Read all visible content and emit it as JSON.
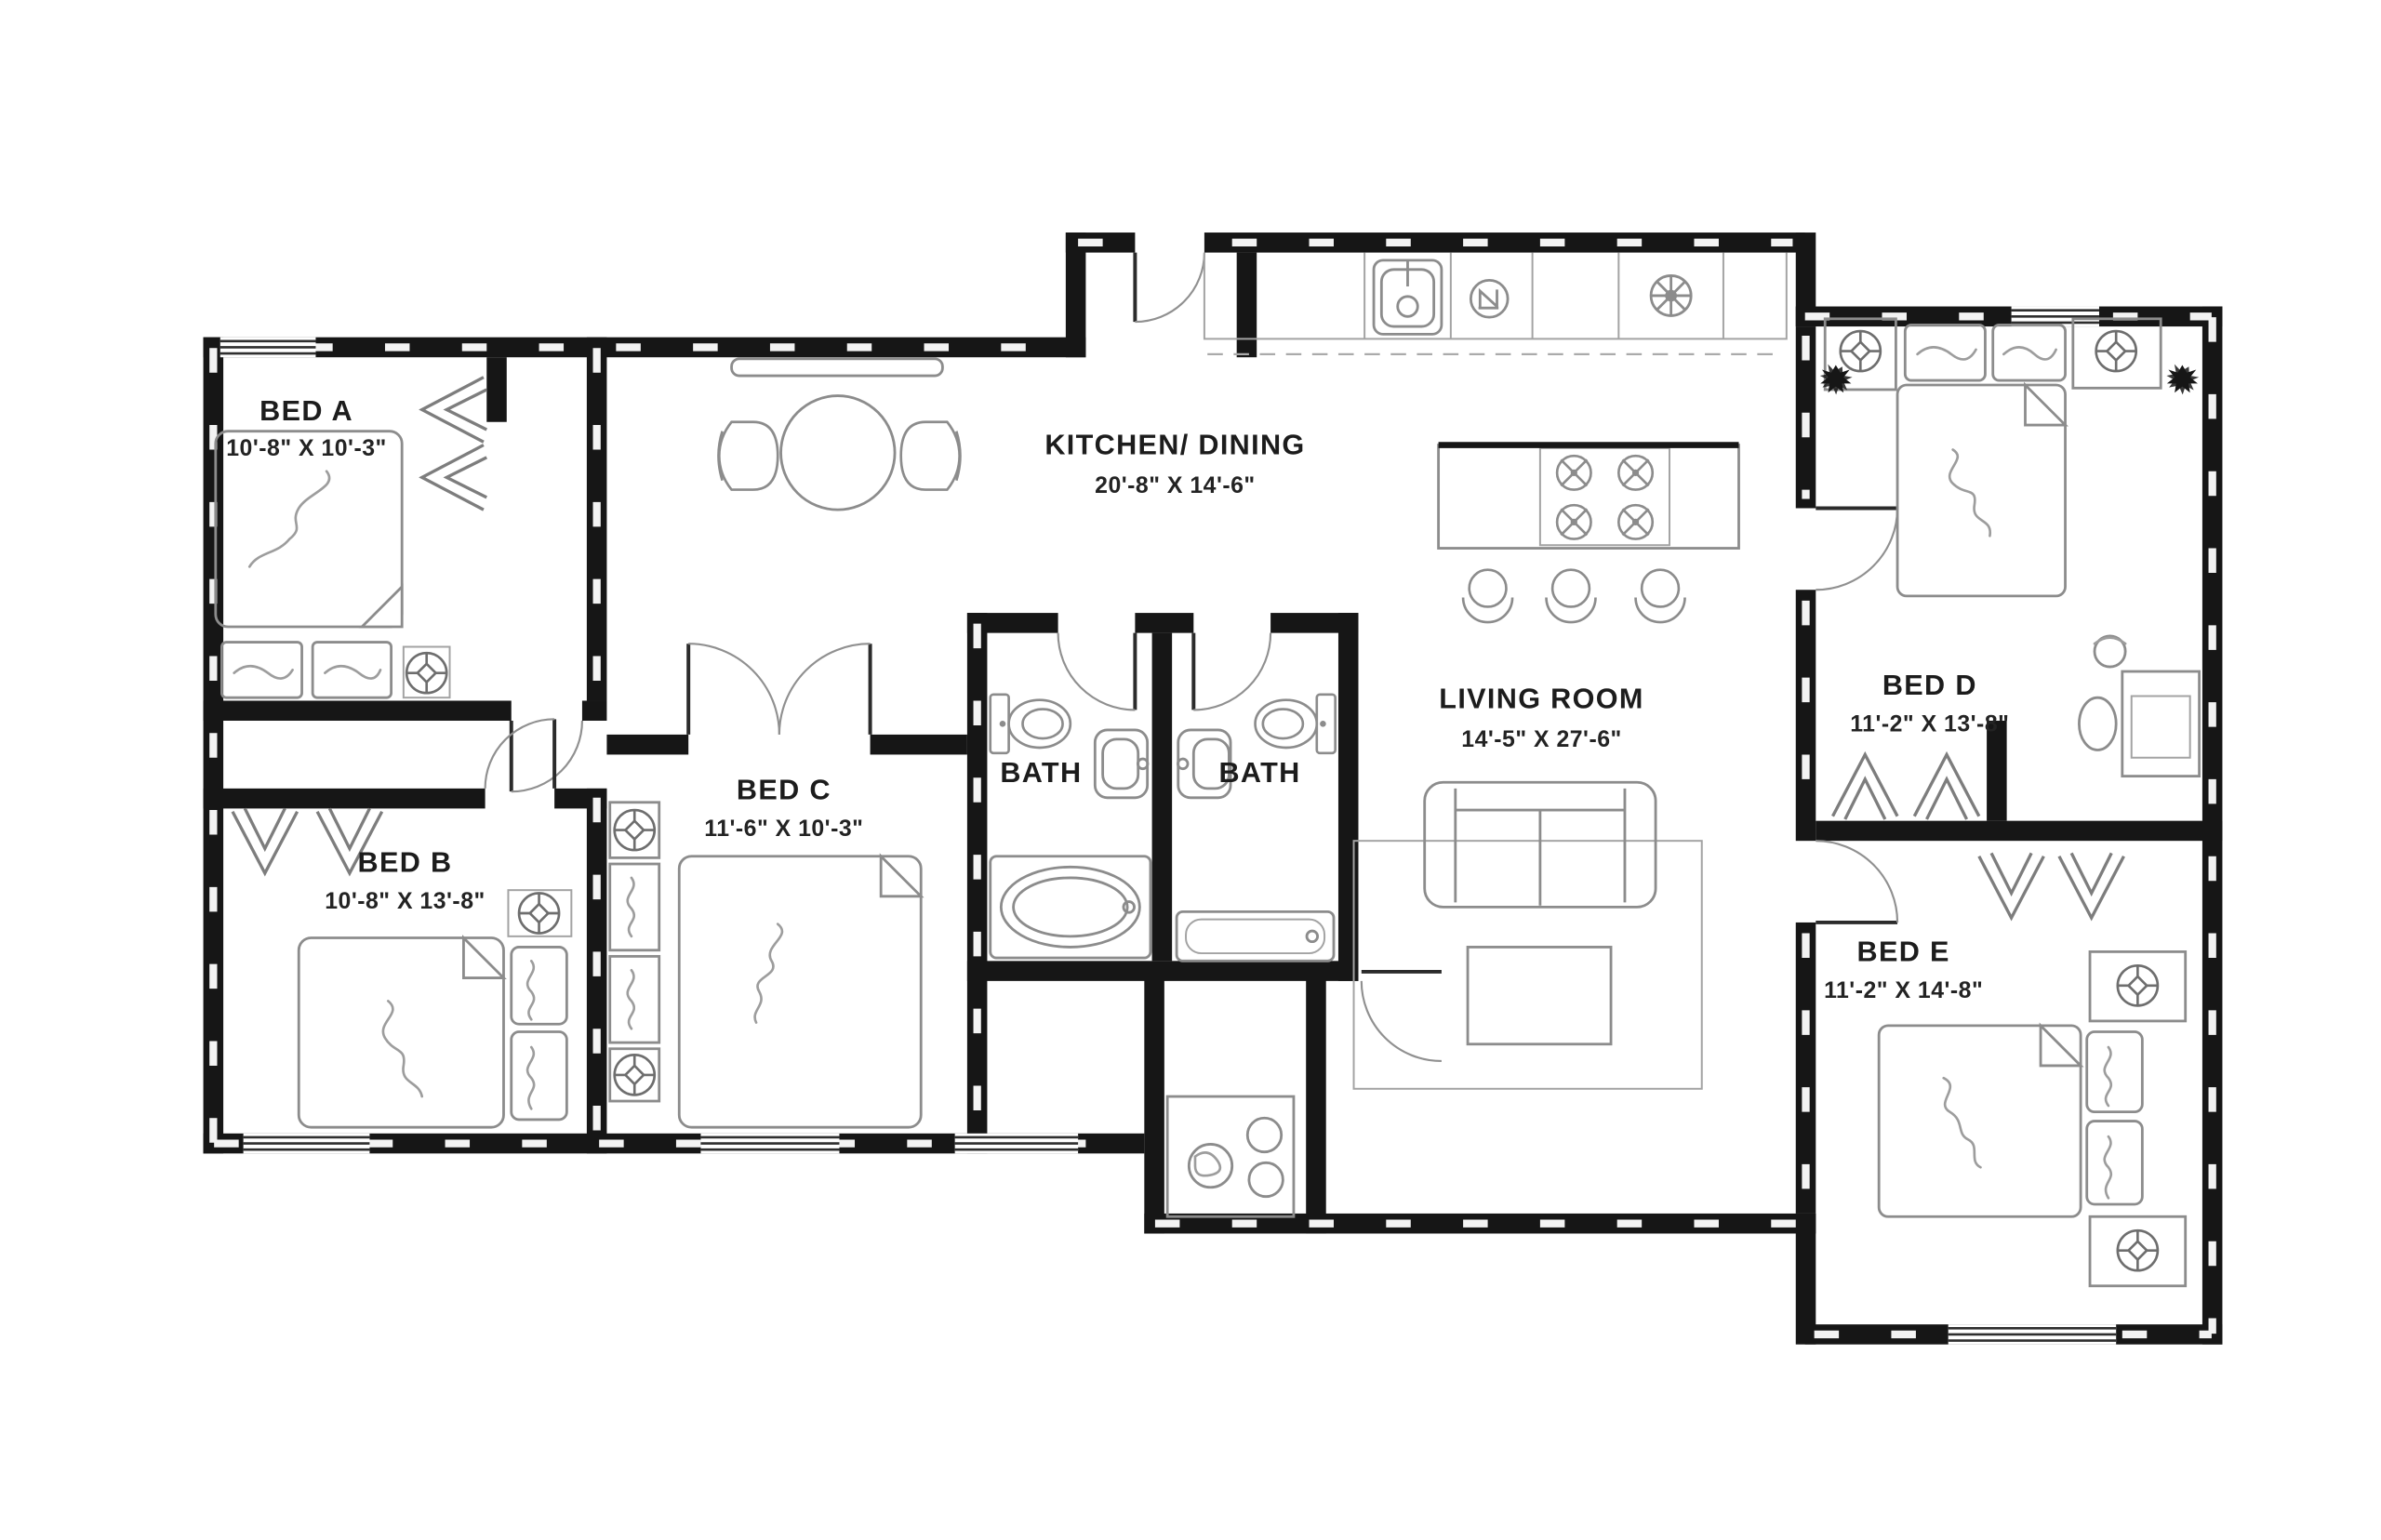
{
  "plan": {
    "rooms": [
      {
        "name": "bed-a",
        "label": "BED A",
        "dims": "10'-8\" X 10'-3\""
      },
      {
        "name": "bed-b",
        "label": "BED B",
        "dims": "10'-8\" X 13'-8\""
      },
      {
        "name": "bed-c",
        "label": "BED C",
        "dims": "11'-6\" X 10'-3\""
      },
      {
        "name": "bed-d",
        "label": "BED D",
        "dims": "11'-2\" X 13'-8\""
      },
      {
        "name": "bed-e",
        "label": "BED E",
        "dims": "11'-2\" X 14'-8\""
      },
      {
        "name": "kitchen-dining",
        "label": "KITCHEN/ DINING",
        "dims": "20'-8\" X 14'-6\""
      },
      {
        "name": "living-room",
        "label": "LIVING ROOM",
        "dims": "14'-5\" X 27'-6\""
      },
      {
        "name": "bath-1",
        "label": "BATH",
        "dims": ""
      },
      {
        "name": "bath-2",
        "label": "BATH",
        "dims": ""
      }
    ],
    "colors": {
      "wall": "#161616",
      "furniture_line": "#8c8c8c",
      "background": "#ffffff",
      "text": "#1c1c1c"
    },
    "fixtures": [
      "kitchen-sink",
      "dishwasher",
      "vent-fan",
      "cooktop-burners",
      "bar-stool",
      "dining-table",
      "dining-chair",
      "console-table",
      "sofa",
      "rug",
      "coffee-table",
      "toilet",
      "vanity-sink",
      "bathtub",
      "shower-tub",
      "washer",
      "double-bed",
      "pillow",
      "dresser",
      "nightstand",
      "ceiling-fan-light",
      "potted-plant",
      "closet-rod-chevron",
      "desk",
      "desk-chair",
      "swing-door",
      "window"
    ]
  }
}
